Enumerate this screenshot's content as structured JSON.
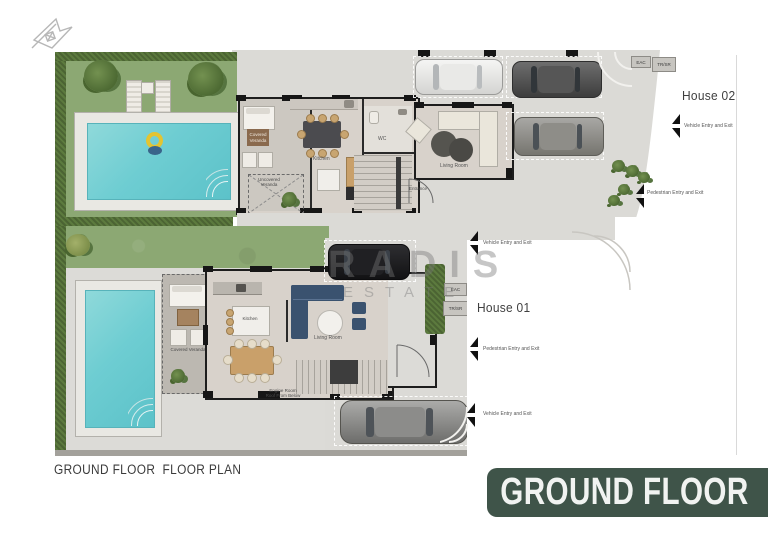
{
  "page": {
    "footer_title": "GROUND FLOOR  FLOOR PLAN",
    "banner_label": "GROUND FLOOR",
    "watermark_line1": "RADIS",
    "watermark_line2": "ESTATE",
    "colors": {
      "banner_green": "#3f5449",
      "pool_water": "#6ecdd2",
      "grass_green": "#8ca873",
      "paving_gray": "#dbdad6",
      "sofa_navy": "#3a526f"
    }
  },
  "house02": {
    "name": "House 02",
    "eac_label": "EAC",
    "trsr_label": "TR/SR",
    "vehicle_entry_label": "Vehicle Entry and Exit",
    "pedestrian_entry_label": "Pedestrian Entry and Exit",
    "rooms": {
      "covered_veranda_line1": "Covered",
      "covered_veranda_line2": "Veranda",
      "uncovered_veranda_line1": "Uncovered",
      "uncovered_veranda_line2": "Veranda",
      "kitchen": "Kitchen",
      "wc": "WC",
      "entrance": "Entrance",
      "living_room": "Living Room"
    }
  },
  "house01": {
    "name": "House 01",
    "eac_label": "EAC",
    "trsr_label": "TR/SR",
    "vehicle_entry_top_label": "Vehicle Entry and Exit",
    "pedestrian_entry_label": "Pedestrian Entry and Exit",
    "vehicle_entry_bottom_label": "Vehicle Entry and Exit",
    "rooms": {
      "covered_veranda": "Covered Veranda",
      "kitchen": "Kitchen",
      "living_room": "Living Room",
      "engine_room_line1": "Engine Room",
      "engine_room_line2": "Roof From Below"
    }
  }
}
